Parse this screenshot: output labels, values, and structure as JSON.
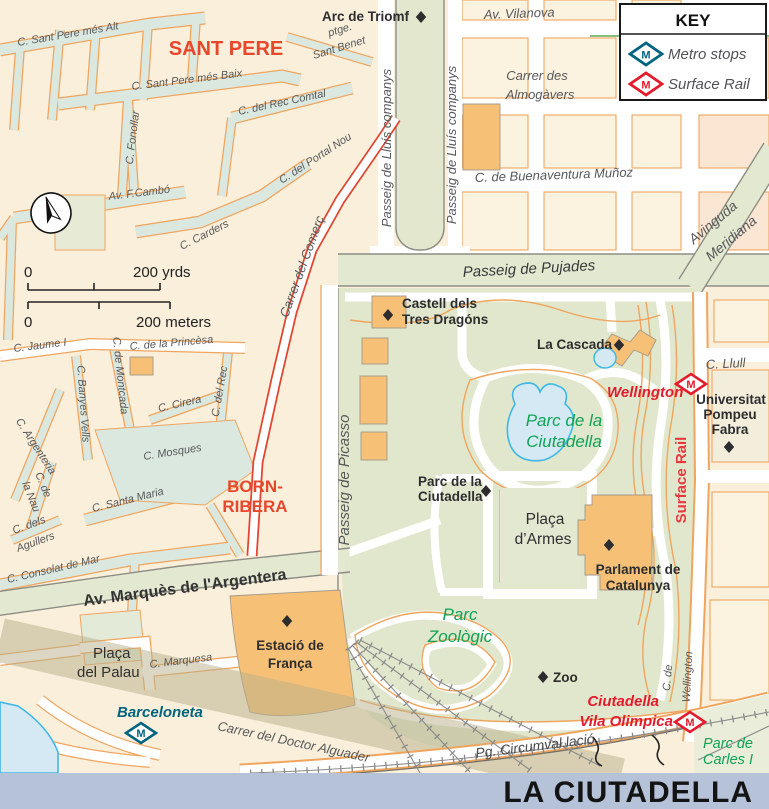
{
  "colors": {
    "background": "#F9EFDB",
    "street_minor": "#DBE8E0",
    "park": "#E1E7CC",
    "road_major": "#E3E8D0",
    "building": "#F6C077",
    "block_outline": "#F0A55E",
    "red_road": "#E2442F",
    "water": "#D5E9F4",
    "lake_outline": "#3FB8E6",
    "metro_blue": "#00647F",
    "rail_red": "#E31C2D",
    "district_red": "#E8472B",
    "park_label_green": "#0FA356",
    "street_label_gray": "#57585A",
    "footer_band": "#B6C2D8"
  },
  "icons": {
    "metro_m": "M"
  },
  "key": {
    "title": "KEY",
    "metro": "Metro stops",
    "rail": "Surface Rail"
  },
  "scale": {
    "y0": "0",
    "y1": "200 yrds",
    "m0": "0",
    "m1": "200 meters"
  },
  "districts": {
    "sant_pere": "SANT PERE",
    "born1": "BORN-",
    "born2": "RIBERA"
  },
  "streets": {
    "alt": "C. Sant Pere més Alt",
    "baix": "C. Sant Pere més Baix",
    "rec_comtal": "C. del Rec Comtal",
    "ptge": "ptge.",
    "sant_benet": "Sant Benet",
    "portal_nou": "C. del Portal Nou",
    "fonollar": "C. Fonollar",
    "cambo": "Av. F.Cambó",
    "carders": "C. Carders",
    "comerc": "Carrer del Comerç",
    "companys_w": "Passeig de Lluís companys",
    "companys_e": "Passeig de Lluís companys",
    "vilanova": "Av. Vilanova",
    "almogavers1": "Carrer des",
    "almogavers2": "Almogàvers",
    "buenaventura": "C. de Buenaventura Muñoz",
    "meridiana1": "Avinguda",
    "meridiana2": "Meridiana",
    "pujades": "Passeig de Pujades",
    "picasso": "Passeig de Picasso",
    "llull": "C. Llull",
    "jaume": "C. Jaume I",
    "princesa": "C. de la Princèsa",
    "montcada": "C. de Montcada",
    "banyes": "C. Banyes Vells",
    "cirera": "C. Cirera",
    "del_rec": "C. del Rec",
    "mosques": "C. Mosques",
    "argenteria": "C. Argenteria",
    "nau1": "C. de",
    "nau2": "la Nau",
    "santa_maria": "C. Santa Maria",
    "agullers1": "C. dels",
    "agullers2": "Agullers",
    "consolat": "C. Consolat de Mar",
    "argentera": "Av. Marquès de l'Argentera",
    "marquesa": "C. Marquesa",
    "palau1": "Plaça",
    "palau2": "del Palau",
    "doctor": "Carrer del Doctor Alguader",
    "circumval": "Pg. Circumval.lació",
    "c_de": "C. de",
    "wellington_st": "Wellington",
    "surface_rail": "Surface Rail"
  },
  "pois": {
    "arc": "Arc de Triomf",
    "castell1": "Castell dels",
    "castell2": "Tres Dragóns",
    "cascada": "La Cascada",
    "parc1": "Parc de la",
    "parc2": "Ciutadella",
    "armes1": "Plaça",
    "armes2": "d’Armes",
    "parlament1": "Parlament de",
    "parlament2": "Catalunya",
    "uni1": "Universitat",
    "uni2": "Pompeu",
    "uni3": "Fabra",
    "estacio1": "Estació de",
    "estacio2": "França",
    "zoo": "Zoo"
  },
  "parks": {
    "lake1": "Parc de la",
    "lake2": "Ciutadella",
    "zoo1": "Parc",
    "zoo2": "Zoològic",
    "carles1": "Parc de",
    "carles2": "Carles I"
  },
  "stations": {
    "wellington": "Wellington",
    "barceloneta": "Barceloneta",
    "ciut1": "Ciutadella",
    "ciut2": "Vila Olimpica"
  },
  "footer": {
    "title": "LA CIUTADELLA"
  }
}
